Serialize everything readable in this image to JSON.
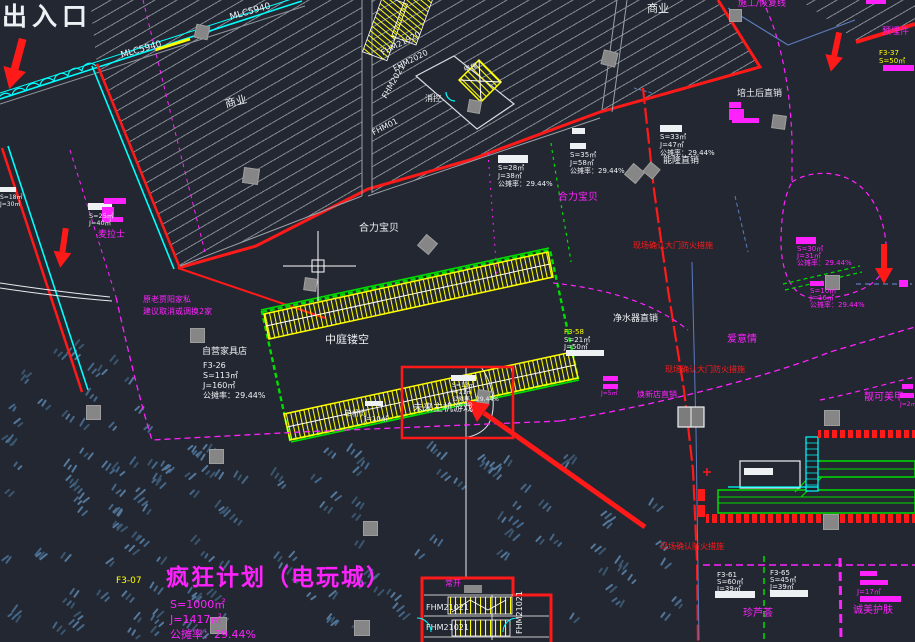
{
  "drawing": {
    "type": "cad-site-plan",
    "background": "#232731",
    "highlight_note": "红框+红色箭头标注 未来主机游戏 铺位"
  },
  "palette": {
    "bg": "#232731",
    "white": "#eef1f4",
    "magenta": "#ff22ff",
    "red": "#ff1a1a",
    "yellow": "#ffff00",
    "cyan": "#00ffff",
    "green": "#00dd00",
    "gray_hatch": "#8f959e",
    "blue": "#5c7cc0",
    "column": "#8a8a8a"
  },
  "labels": [
    {
      "name": "entrance",
      "text": "出入口",
      "x": 2,
      "y": 4,
      "color": "white",
      "size": 25,
      "bold": true,
      "ls": 5
    },
    {
      "name": "wall-code-1",
      "text": "MLC5940",
      "x": 120,
      "y": 52,
      "color": "white",
      "size": 9,
      "rot": -16
    },
    {
      "name": "wall-code-2",
      "text": "MLC5940",
      "x": 229,
      "y": 14,
      "color": "white",
      "size": 9,
      "rot": -16
    },
    {
      "name": "commercial-left",
      "text": "商业",
      "x": 224,
      "y": 99,
      "color": "white",
      "size": 11,
      "rot": -14
    },
    {
      "name": "commercial-top",
      "text": "商业",
      "x": 647,
      "y": 3,
      "color": "white",
      "size": 11
    },
    {
      "name": "shutter-1",
      "text": "FHM21920",
      "x": 380,
      "y": 50,
      "color": "white",
      "size": 8,
      "rot": -27
    },
    {
      "name": "shutter-2",
      "text": "FHM2020",
      "x": 392,
      "y": 66,
      "color": "white",
      "size": 8,
      "rot": -27
    },
    {
      "name": "shutter-3",
      "text": "FHM2021",
      "x": 381,
      "y": 96,
      "color": "white",
      "size": 8,
      "rot": -60
    },
    {
      "name": "shutter-4",
      "text": "FHM01",
      "x": 371,
      "y": 130,
      "color": "white",
      "size": 8,
      "rot": -27
    },
    {
      "name": "fire-room",
      "text": "消控",
      "x": 425,
      "y": 95,
      "color": "white",
      "size": 8
    },
    {
      "name": "elevator",
      "text": "电梯",
      "x": 463,
      "y": 67,
      "color": "white",
      "size": 7,
      "rot": -18
    },
    {
      "name": "heli-baby-white",
      "text": "合力宝贝",
      "x": 359,
      "y": 224,
      "color": "white",
      "size": 10
    },
    {
      "name": "heli-baby-magenta",
      "text": "合力宝贝",
      "x": 558,
      "y": 193,
      "color": "magenta",
      "size": 10
    },
    {
      "name": "atrium",
      "text": "中庭镂空",
      "x": 325,
      "y": 334,
      "color": "white",
      "size": 11
    },
    {
      "name": "future-console-games",
      "text": "未来主机游戏",
      "x": 413,
      "y": 404,
      "color": "white",
      "size": 10
    },
    {
      "name": "furniture-title",
      "text": "自营家具店",
      "x": 202,
      "y": 348,
      "color": "white",
      "size": 9
    },
    {
      "name": "furniture-code",
      "text": "F3-26",
      "x": 203,
      "y": 362,
      "color": "white",
      "size": 8
    },
    {
      "name": "furniture-s",
      "text": "S=113㎡",
      "x": 203,
      "y": 372,
      "color": "white",
      "size": 8
    },
    {
      "name": "furniture-j",
      "text": "J=160㎡",
      "x": 203,
      "y": 382,
      "color": "white",
      "size": 8
    },
    {
      "name": "furniture-rate",
      "text": "公摊率：29.44%",
      "x": 203,
      "y": 392,
      "color": "white",
      "size": 8
    },
    {
      "name": "note-old-tenant",
      "text": "原老贾阳家私",
      "x": 143,
      "y": 296,
      "color": "magenta",
      "size": 8
    },
    {
      "name": "note-suggest",
      "text": "建议取消或调换2家",
      "x": 143,
      "y": 308,
      "color": "magenta",
      "size": 8
    },
    {
      "name": "shop-mailashi",
      "text": "麦拉士",
      "x": 98,
      "y": 231,
      "color": "magenta",
      "size": 9
    },
    {
      "name": "arcade-title",
      "text": "疯狂计划（电玩城）",
      "x": 166,
      "y": 566,
      "color": "magenta",
      "size": 23,
      "bold": true,
      "ls": 2
    },
    {
      "name": "arcade-code",
      "text": "F3-07",
      "x": 116,
      "y": 577,
      "color": "yellow",
      "size": 9
    },
    {
      "name": "arcade-s",
      "text": "S=1000㎡",
      "x": 170,
      "y": 599,
      "color": "magenta",
      "size": 11
    },
    {
      "name": "arcade-j",
      "text": "J=1417㎡",
      "x": 170,
      "y": 614,
      "color": "magenta",
      "size": 11
    },
    {
      "name": "arcade-rate",
      "text": "公摊率：29.44%",
      "x": 170,
      "y": 629,
      "color": "magenta",
      "size": 11
    },
    {
      "name": "corner-note",
      "text": "施工/恢复线",
      "x": 738,
      "y": 0,
      "color": "magenta",
      "size": 9
    },
    {
      "name": "embed-note",
      "text": "预埋件",
      "x": 882,
      "y": 28,
      "color": "magenta",
      "size": 9
    },
    {
      "name": "shop-peitu",
      "text": "培土后直销",
      "x": 737,
      "y": 90,
      "color": "white",
      "size": 9
    },
    {
      "name": "shop-nenglong",
      "text": "能隆直销",
      "x": 663,
      "y": 157,
      "color": "white",
      "size": 9
    },
    {
      "name": "shop-jingshui",
      "text": "净水器直销",
      "x": 613,
      "y": 315,
      "color": "white",
      "size": 9
    },
    {
      "name": "shop-aiyiqing",
      "text": "爱意情",
      "x": 727,
      "y": 335,
      "color": "magenta",
      "size": 10
    },
    {
      "name": "shop-nails",
      "text": "靓可美甲",
      "x": 864,
      "y": 393,
      "color": "magenta",
      "size": 10
    },
    {
      "name": "shop-huanxin",
      "text": "焕新店直销",
      "x": 637,
      "y": 391,
      "color": "magenta",
      "size": 8
    },
    {
      "name": "shop-aloe",
      "text": "珍芦荟",
      "x": 743,
      "y": 609,
      "color": "magenta",
      "size": 10
    },
    {
      "name": "shop-skincare",
      "text": "诚美护肤",
      "x": 853,
      "y": 606,
      "color": "magenta",
      "size": 10
    },
    {
      "name": "fire-note-1",
      "text": "现场确认大门防火措施",
      "x": 633,
      "y": 242,
      "color": "red",
      "size": 8
    },
    {
      "name": "fire-note-2",
      "text": "现场确认大门防火措施",
      "x": 665,
      "y": 366,
      "color": "red",
      "size": 8
    },
    {
      "name": "fire-note-3",
      "text": "现场确认防火措施",
      "x": 660,
      "y": 543,
      "color": "red",
      "size": 8
    },
    {
      "name": "stair-code-b1",
      "text": "FHM21021",
      "x": 426,
      "y": 604,
      "color": "white",
      "size": 8
    },
    {
      "name": "stair-code-b2",
      "text": "FHM21021",
      "x": 426,
      "y": 624,
      "color": "white",
      "size": 8
    },
    {
      "name": "stair-code-b3",
      "text": "FHM21021",
      "x": 516,
      "y": 634,
      "color": "white",
      "size": 8,
      "rot": -90
    },
    {
      "name": "normally-open",
      "text": "常开",
      "x": 445,
      "y": 580,
      "color": "magenta",
      "size": 8
    },
    {
      "name": "pole-light",
      "text": "单杆灯",
      "x": 344,
      "y": 410,
      "color": "white",
      "size": 8
    },
    {
      "name": "pole-light-j",
      "text": "J=10㎡",
      "x": 364,
      "y": 416,
      "color": "white",
      "size": 7
    },
    {
      "name": "unit-f337",
      "text": "F3-37",
      "x": 879,
      "y": 50,
      "color": "yellow",
      "size": 7
    },
    {
      "name": "unit-f337-s",
      "text": "S=50㎡",
      "x": 879,
      "y": 58,
      "color": "yellow",
      "size": 7
    },
    {
      "name": "blk1-s",
      "text": "S=28㎡",
      "x": 498,
      "y": 165,
      "color": "white",
      "size": 7
    },
    {
      "name": "blk1-j",
      "text": "J=38㎡",
      "x": 498,
      "y": 173,
      "color": "white",
      "size": 7
    },
    {
      "name": "blk1-rate",
      "text": "公摊率：29.44%",
      "x": 498,
      "y": 181,
      "color": "white",
      "size": 7
    },
    {
      "name": "blk2-s",
      "text": "S=35㎡",
      "x": 570,
      "y": 152,
      "color": "white",
      "size": 7
    },
    {
      "name": "blk2-j",
      "text": "J=58㎡",
      "x": 570,
      "y": 160,
      "color": "white",
      "size": 7
    },
    {
      "name": "blk2-rate",
      "text": "公摊率：29.44%",
      "x": 570,
      "y": 168,
      "color": "white",
      "size": 7
    },
    {
      "name": "blk3-s",
      "text": "S=33㎡",
      "x": 660,
      "y": 134,
      "color": "white",
      "size": 7
    },
    {
      "name": "blk3-j",
      "text": "J=47㎡",
      "x": 660,
      "y": 142,
      "color": "white",
      "size": 7
    },
    {
      "name": "blk3-rate",
      "text": "公摊率：29.44%",
      "x": 660,
      "y": 150,
      "color": "white",
      "size": 7
    },
    {
      "name": "blk4-s",
      "text": "S=13㎡",
      "x": 452,
      "y": 383,
      "color": "white",
      "size": 6
    },
    {
      "name": "blk4-j",
      "text": "J=21㎡",
      "x": 452,
      "y": 390,
      "color": "white",
      "size": 6
    },
    {
      "name": "blk4-rate",
      "text": "公摊率：29.44%",
      "x": 452,
      "y": 397,
      "color": "white",
      "size": 6
    },
    {
      "name": "blk5-s",
      "text": "S=30㎡",
      "x": 797,
      "y": 246,
      "color": "magenta",
      "size": 7
    },
    {
      "name": "blk5-j",
      "text": "J=31㎡",
      "x": 797,
      "y": 253,
      "color": "magenta",
      "size": 7
    },
    {
      "name": "blk5-rate",
      "text": "公摊率：29.44%",
      "x": 797,
      "y": 260,
      "color": "magenta",
      "size": 7
    },
    {
      "name": "blk6-s",
      "text": "S=10㎡",
      "x": 810,
      "y": 288,
      "color": "magenta",
      "size": 7
    },
    {
      "name": "blk6-j",
      "text": "J=16㎡",
      "x": 810,
      "y": 295,
      "color": "magenta",
      "size": 7
    },
    {
      "name": "blk6-rate",
      "text": "公摊率：29.44%",
      "x": 810,
      "y": 302,
      "color": "magenta",
      "size": 7
    },
    {
      "name": "blk7-code",
      "text": "F3-61",
      "x": 717,
      "y": 572,
      "color": "white",
      "size": 7
    },
    {
      "name": "blk7-s",
      "text": "S=60㎡",
      "x": 717,
      "y": 579,
      "color": "white",
      "size": 7
    },
    {
      "name": "blk7-j",
      "text": "J=39㎡",
      "x": 717,
      "y": 586,
      "color": "white",
      "size": 7
    },
    {
      "name": "blk8-code",
      "text": "F3-65",
      "x": 770,
      "y": 570,
      "color": "white",
      "size": 7
    },
    {
      "name": "blk8-s",
      "text": "S=45㎡",
      "x": 770,
      "y": 577,
      "color": "white",
      "size": 7
    },
    {
      "name": "blk8-j",
      "text": "J=39㎡",
      "x": 770,
      "y": 584,
      "color": "white",
      "size": 7
    },
    {
      "name": "blk9-code",
      "text": "F3-58",
      "x": 564,
      "y": 329,
      "color": "yellow",
      "size": 7
    },
    {
      "name": "blk9-s",
      "text": "S=21㎡",
      "x": 564,
      "y": 337,
      "color": "white",
      "size": 7
    },
    {
      "name": "blk9-j",
      "text": "J=50㎡",
      "x": 564,
      "y": 344,
      "color": "white",
      "size": 7
    },
    {
      "name": "blk10-j",
      "text": "J=17㎡",
      "x": 857,
      "y": 589,
      "color": "magenta",
      "size": 7
    },
    {
      "name": "blk11-j",
      "text": "J=2㎡",
      "x": 900,
      "y": 402,
      "color": "magenta",
      "size": 6
    },
    {
      "name": "blk12-j",
      "text": "J=5㎡",
      "x": 601,
      "y": 391,
      "color": "magenta",
      "size": 6
    },
    {
      "name": "blk13-s",
      "text": "S=25㎡",
      "x": 89,
      "y": 213,
      "color": "white",
      "size": 6.5
    },
    {
      "name": "blk13-j",
      "text": "J=40㎡",
      "x": 89,
      "y": 220,
      "color": "white",
      "size": 6.5
    },
    {
      "name": "blk14-s",
      "text": "S=18㎡",
      "x": 0,
      "y": 195,
      "color": "white",
      "size": 6
    },
    {
      "name": "blk14-j",
      "text": "J=30㎡",
      "x": 0,
      "y": 202,
      "color": "white",
      "size": 6
    }
  ],
  "bars": [
    {
      "x": 498,
      "y": 155,
      "w": 30,
      "h": 8,
      "c": "white"
    },
    {
      "x": 572,
      "y": 128,
      "w": 13,
      "h": 6,
      "c": "white"
    },
    {
      "x": 570,
      "y": 143,
      "w": 16,
      "h": 6,
      "c": "white"
    },
    {
      "x": 660,
      "y": 125,
      "w": 22,
      "h": 7,
      "c": "white"
    },
    {
      "x": 451,
      "y": 375,
      "w": 25,
      "h": 6,
      "c": "white"
    },
    {
      "x": 566,
      "y": 350,
      "w": 38,
      "h": 6,
      "c": "white"
    },
    {
      "x": 365,
      "y": 401,
      "w": 18,
      "h": 5,
      "c": "white"
    },
    {
      "x": 715,
      "y": 591,
      "w": 40,
      "h": 7,
      "c": "white"
    },
    {
      "x": 770,
      "y": 590,
      "w": 38,
      "h": 7,
      "c": "white"
    },
    {
      "x": 88,
      "y": 203,
      "w": 24,
      "h": 7,
      "c": "white"
    },
    {
      "x": 0,
      "y": 187,
      "w": 16,
      "h": 5,
      "c": "white"
    },
    {
      "x": 744,
      "y": 468,
      "w": 29,
      "h": 7,
      "c": "white"
    },
    {
      "x": 796,
      "y": 237,
      "w": 20,
      "h": 7,
      "c": "magenta"
    },
    {
      "x": 810,
      "y": 281,
      "w": 14,
      "h": 5,
      "c": "magenta"
    },
    {
      "x": 860,
      "y": 571,
      "w": 17,
      "h": 5,
      "c": "magenta"
    },
    {
      "x": 860,
      "y": 580,
      "w": 28,
      "h": 5,
      "c": "magenta"
    },
    {
      "x": 860,
      "y": 596,
      "w": 41,
      "h": 6,
      "c": "magenta"
    },
    {
      "x": 902,
      "y": 384,
      "w": 11,
      "h": 5,
      "c": "magenta"
    },
    {
      "x": 900,
      "y": 393,
      "w": 14,
      "h": 5,
      "c": "magenta"
    },
    {
      "x": 603,
      "y": 376,
      "w": 15,
      "h": 5,
      "c": "magenta"
    },
    {
      "x": 603,
      "y": 384,
      "w": 15,
      "h": 5,
      "c": "magenta"
    },
    {
      "x": 732,
      "y": 118,
      "w": 27,
      "h": 5,
      "c": "magenta"
    },
    {
      "x": 883,
      "y": 65,
      "w": 31,
      "h": 6,
      "c": "magenta"
    },
    {
      "x": 866,
      "y": 0,
      "w": 20,
      "h": 4,
      "c": "magenta"
    },
    {
      "x": 104,
      "y": 198,
      "w": 22,
      "h": 6,
      "c": "magenta"
    },
    {
      "x": 102,
      "y": 207,
      "w": 12,
      "h": 14,
      "c": "magenta"
    },
    {
      "x": 102,
      "y": 217,
      "w": 21,
      "h": 5,
      "c": "magenta"
    },
    {
      "x": 729,
      "y": 102,
      "w": 12,
      "h": 6,
      "c": "magenta"
    },
    {
      "x": 729,
      "y": 109,
      "w": 15,
      "h": 11,
      "c": "magenta"
    },
    {
      "x": 899,
      "y": 280,
      "w": 9,
      "h": 7,
      "c": "magenta"
    }
  ]
}
